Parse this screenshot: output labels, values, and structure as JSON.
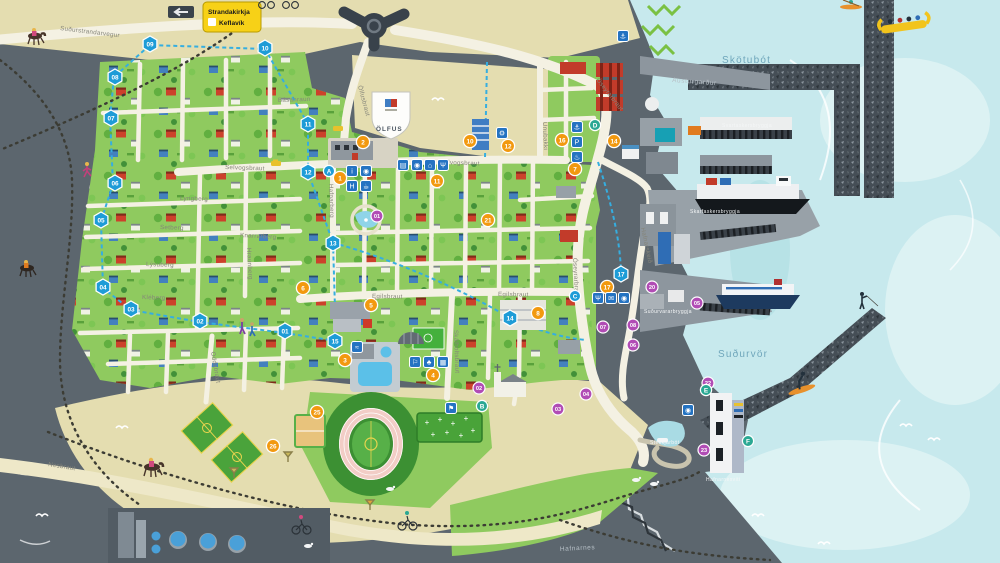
{
  "sign": {
    "line1": "Strandakirkja",
    "line2": "Keflavík"
  },
  "crest": {
    "text": "ÖLFUS"
  },
  "colors": {
    "sea": "#c7e9ed",
    "sea_light": "#dcf2f3",
    "rock": "#5c666e",
    "sand": "#e4ddb0",
    "town_green": "#8fca5f",
    "field_green": "#4aa33b",
    "road": "#f4f1e3",
    "route_blue": "#35aee0",
    "marker_blue": "#1e9cd7",
    "marker_orange": "#f2990f",
    "marker_purple": "#b14cb5",
    "marker_teal": "#2aa893",
    "icon_blue": "#2473c2",
    "sign_yellow": "#f7d117"
  },
  "labels": [
    {
      "t": "Suðurstrandarvegur",
      "x": 60,
      "y": 30,
      "r": 7,
      "k": "street"
    },
    {
      "t": "Ölfusbraut",
      "x": 358,
      "y": 86,
      "r": 75,
      "k": "street"
    },
    {
      "t": "Óseyrarbraut",
      "x": 596,
      "y": 80,
      "r": 52,
      "k": "street"
    },
    {
      "t": "Óseyrarbraut",
      "x": 573,
      "y": 258,
      "r": 87,
      "k": "street"
    },
    {
      "t": "Básahraun",
      "x": 278,
      "y": 102,
      "r": -2,
      "k": "street"
    },
    {
      "t": "Selvogsbraut",
      "x": 225,
      "y": 169,
      "r": 2,
      "k": "street"
    },
    {
      "t": "Selvogsbraut",
      "x": 440,
      "y": 164,
      "r": 2,
      "k": "street"
    },
    {
      "t": "Lyngberg",
      "x": 180,
      "y": 200,
      "r": 2,
      "k": "street"
    },
    {
      "t": "Setberg",
      "x": 160,
      "y": 229,
      "r": 2,
      "k": "street"
    },
    {
      "t": "Lýsuberg",
      "x": 146,
      "y": 266,
      "r": 2,
      "k": "street"
    },
    {
      "t": "Kléberg",
      "x": 142,
      "y": 299,
      "r": 2,
      "k": "street"
    },
    {
      "t": "Knarrarberg",
      "x": 240,
      "y": 237,
      "r": 3,
      "k": "street"
    },
    {
      "t": "Hraunberg",
      "x": 247,
      "y": 248,
      "r": 87,
      "k": "street"
    },
    {
      "t": "Hafnarberg",
      "x": 329,
      "y": 184,
      "r": 88,
      "k": "street"
    },
    {
      "t": "Egilsbraut",
      "x": 372,
      "y": 298,
      "r": 1,
      "k": "street"
    },
    {
      "t": "Egilsbraut",
      "x": 498,
      "y": 296,
      "r": 1,
      "k": "street"
    },
    {
      "t": "Unubakki",
      "x": 543,
      "y": 122,
      "r": 88,
      "k": "street"
    },
    {
      "t": "Hafnarskeið",
      "x": 641,
      "y": 228,
      "r": 78,
      "k": "street"
    },
    {
      "t": "Skálholtsbraut",
      "x": 454,
      "y": 330,
      "r": 88,
      "k": "street"
    },
    {
      "t": "Oddabraut",
      "x": 211,
      "y": 352,
      "r": 80,
      "k": "street"
    },
    {
      "t": "Nesbraut",
      "x": 48,
      "y": 466,
      "r": 9,
      "k": "street"
    },
    {
      "t": "Skötubót",
      "x": 722,
      "y": 63,
      "r": 0,
      "k": "sea"
    },
    {
      "t": "Suðurvör",
      "x": 718,
      "y": 357,
      "r": 0,
      "k": "sea"
    },
    {
      "t": "Austurgarður",
      "x": 672,
      "y": 82,
      "r": 4,
      "k": "area"
    },
    {
      "t": "Hafnarnes",
      "x": 560,
      "y": 551,
      "r": -3,
      "k": "area"
    },
    {
      "t": "Svartaskersbryggja",
      "x": 722,
      "y": 127,
      "r": 0,
      "k": "pier"
    },
    {
      "t": "Skarfaskersbryggja",
      "x": 690,
      "y": 213,
      "r": 0,
      "k": "pier"
    },
    {
      "t": "Suðurvararbryggja",
      "x": 644,
      "y": 313,
      "r": 0,
      "k": "pier"
    },
    {
      "t": "Stekkjarbót",
      "x": 650,
      "y": 444,
      "r": 0,
      "k": "pier"
    },
    {
      "t": "Hafnarnesviti",
      "x": 706,
      "y": 481,
      "r": 0,
      "k": "pier"
    }
  ],
  "route_markers": [
    {
      "n": "01",
      "x": 285,
      "y": 331
    },
    {
      "n": "02",
      "x": 200,
      "y": 321
    },
    {
      "n": "03",
      "x": 131,
      "y": 309
    },
    {
      "n": "04",
      "x": 103,
      "y": 287
    },
    {
      "n": "05",
      "x": 101,
      "y": 220
    },
    {
      "n": "06",
      "x": 115,
      "y": 183
    },
    {
      "n": "07",
      "x": 111,
      "y": 118
    },
    {
      "n": "08",
      "x": 115,
      "y": 77
    },
    {
      "n": "09",
      "x": 150,
      "y": 44
    },
    {
      "n": "10",
      "x": 265,
      "y": 48
    },
    {
      "n": "11",
      "x": 308,
      "y": 124
    },
    {
      "n": "12",
      "x": 308,
      "y": 172
    },
    {
      "n": "13",
      "x": 333,
      "y": 243
    },
    {
      "n": "14",
      "x": 510,
      "y": 318
    },
    {
      "n": "15",
      "x": 335,
      "y": 341
    },
    {
      "n": "17",
      "x": 621,
      "y": 274
    }
  ],
  "poi_markers": [
    {
      "n": "1",
      "x": 340,
      "y": 178
    },
    {
      "n": "2",
      "x": 363,
      "y": 142
    },
    {
      "n": "3",
      "x": 345,
      "y": 360
    },
    {
      "n": "4",
      "x": 433,
      "y": 375
    },
    {
      "n": "5",
      "x": 371,
      "y": 305
    },
    {
      "n": "6",
      "x": 303,
      "y": 288
    },
    {
      "n": "7",
      "x": 575,
      "y": 169
    },
    {
      "n": "8",
      "x": 538,
      "y": 313
    },
    {
      "n": "10",
      "x": 470,
      "y": 141
    },
    {
      "n": "11",
      "x": 437,
      "y": 181
    },
    {
      "n": "12",
      "x": 508,
      "y": 146
    },
    {
      "n": "14",
      "x": 614,
      "y": 141
    },
    {
      "n": "16",
      "x": 562,
      "y": 140
    },
    {
      "n": "17",
      "x": 607,
      "y": 287
    },
    {
      "n": "21",
      "x": 488,
      "y": 220
    },
    {
      "n": "25",
      "x": 317,
      "y": 412
    },
    {
      "n": "26",
      "x": 273,
      "y": 446
    }
  ],
  "info_markers": [
    {
      "n": "01",
      "x": 377,
      "y": 216
    },
    {
      "n": "02",
      "x": 479,
      "y": 388
    },
    {
      "n": "03",
      "x": 558,
      "y": 409
    },
    {
      "n": "04",
      "x": 586,
      "y": 394
    },
    {
      "n": "05",
      "x": 697,
      "y": 303
    },
    {
      "n": "06",
      "x": 633,
      "y": 345
    },
    {
      "n": "07",
      "x": 603,
      "y": 327
    },
    {
      "n": "08",
      "x": 633,
      "y": 325
    },
    {
      "n": "20",
      "x": 652,
      "y": 287
    },
    {
      "n": "22",
      "x": 708,
      "y": 383
    },
    {
      "n": "23",
      "x": 704,
      "y": 450
    }
  ],
  "letter_markers": [
    {
      "n": "A",
      "x": 329,
      "y": 171,
      "c": "blue"
    },
    {
      "n": "B",
      "x": 482,
      "y": 406,
      "c": "teal"
    },
    {
      "n": "C",
      "x": 575,
      "y": 296,
      "c": "blue"
    },
    {
      "n": "D",
      "x": 595,
      "y": 125,
      "c": "teal"
    },
    {
      "n": "E",
      "x": 706,
      "y": 390,
      "c": "teal"
    },
    {
      "n": "F",
      "x": 748,
      "y": 441,
      "c": "teal"
    }
  ],
  "icon_squares": [
    {
      "g": "i",
      "n": "info-icon",
      "x": 352,
      "y": 171
    },
    {
      "g": "◉",
      "n": "viewpoint-icon",
      "x": 366,
      "y": 171
    },
    {
      "g": "H",
      "n": "hotel-icon",
      "x": 352,
      "y": 186
    },
    {
      "g": "☕",
      "n": "cafe-icon",
      "x": 366,
      "y": 186
    },
    {
      "g": "▤",
      "n": "museum-icon",
      "x": 403,
      "y": 165
    },
    {
      "g": "◉",
      "n": "camera-icon",
      "x": 417,
      "y": 165
    },
    {
      "g": "⌂",
      "n": "cabin-icon",
      "x": 430,
      "y": 165
    },
    {
      "g": "Ψ",
      "n": "restaurant-icon",
      "x": 443,
      "y": 165
    },
    {
      "g": "≈",
      "n": "swimming-icon",
      "x": 357,
      "y": 347
    },
    {
      "g": "⚐",
      "n": "playground-icon",
      "x": 415,
      "y": 362
    },
    {
      "g": "♣",
      "n": "park-icon",
      "x": 429,
      "y": 362
    },
    {
      "g": "▦",
      "n": "picnic-icon",
      "x": 443,
      "y": 362
    },
    {
      "g": "⚑",
      "n": "golf-icon",
      "x": 451,
      "y": 408
    },
    {
      "g": "⚓",
      "n": "anchor-icon",
      "x": 577,
      "y": 127
    },
    {
      "g": "P",
      "n": "parking-icon",
      "x": 577,
      "y": 142
    },
    {
      "g": "♨",
      "n": "hot-tub-icon",
      "x": 577,
      "y": 157
    },
    {
      "g": "Ψ",
      "n": "dining-icon",
      "x": 598,
      "y": 298
    },
    {
      "g": "✉",
      "n": "post-icon",
      "x": 611,
      "y": 298
    },
    {
      "g": "◉",
      "n": "lookout-icon",
      "x": 624,
      "y": 298
    },
    {
      "g": "⚓",
      "n": "marina-icon",
      "x": 623,
      "y": 36
    },
    {
      "g": "◉",
      "n": "photo-spot-icon",
      "x": 688,
      "y": 410
    },
    {
      "g": "⚙",
      "n": "workshop-icon",
      "x": 502,
      "y": 133
    }
  ]
}
